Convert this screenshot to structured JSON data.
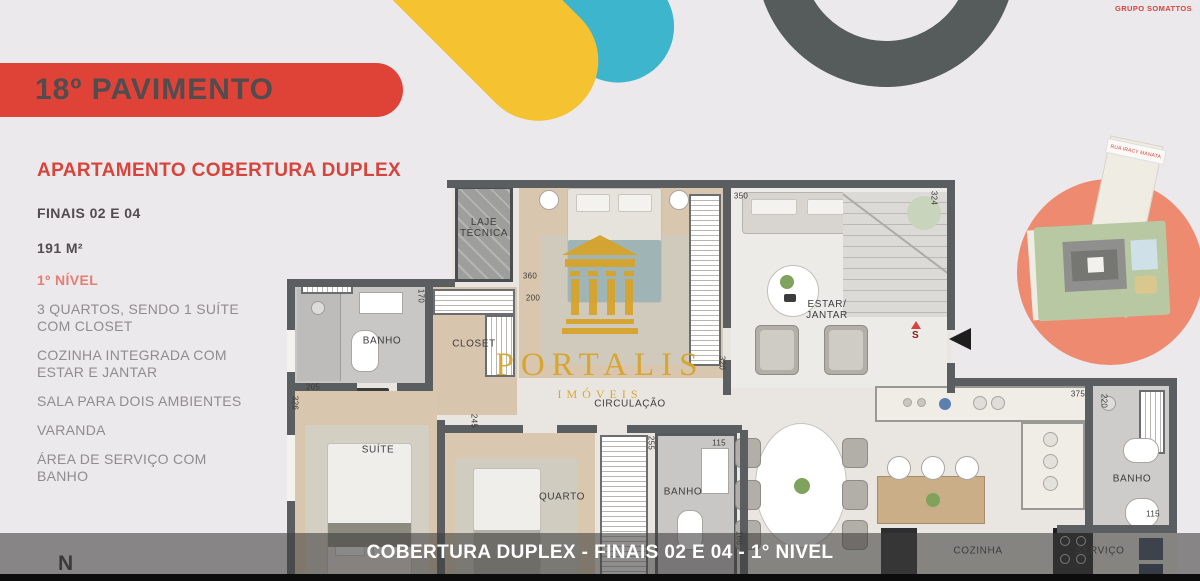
{
  "brand": {
    "name": "GRUPO SOMATTOS"
  },
  "banner": {
    "title": "18º PAVIMENTO"
  },
  "info_panel": {
    "title": "APARTAMENTO COBERTURA DUPLEX",
    "finais": "FINAIS 02 E 04",
    "area": "191 M²",
    "level": "1º NÍVEL",
    "features": [
      "3 QUARTOS, SENDO 1 SUÍTE COM CLOSET",
      "COZINHA INTEGRADA COM ESTAR E JANTAR",
      "SALA PARA DOIS AMBIENTES",
      "VARANDA",
      "ÁREA DE SERVIÇO COM BANHO"
    ]
  },
  "floor_plan": {
    "rooms": {
      "laje_tecnica": "LAJE\nTÉCNICA",
      "banho_suite": "BANHO",
      "closet": "CLOSET",
      "suite": "SUÍTE",
      "quarto": "QUARTO",
      "circulacao": "CIRCULAÇÃO",
      "banho_meio": "BANHO",
      "estar_jantar": "ESTAR/\nJANTAR",
      "cozinha": "COZINHA",
      "servico": "SERVIÇO",
      "banho_servico": "BANHO"
    },
    "dimensions": [
      "360",
      "200",
      "350",
      "324",
      "320",
      "170",
      "205",
      "326",
      "245",
      "255",
      "115",
      "166",
      "375",
      "220",
      "115"
    ],
    "stairs_marker": "S",
    "compass": "N",
    "watermark": {
      "brand": "PORTALIS",
      "tagline": "IMÓVEIS"
    }
  },
  "site_plan": {
    "street_label": "RUA IRACY MANATA"
  },
  "footer": {
    "caption": "COBERTURA DUPLEX - FINAIS 02 E 04 - 1° NIVEL"
  },
  "colors": {
    "accent_red": "#df4237",
    "salmon": "#ee8a6f",
    "yellow": "#f5c231",
    "teal": "#3db5cc",
    "dark_gray": "#565b5b",
    "gold": "#d7a42c"
  }
}
